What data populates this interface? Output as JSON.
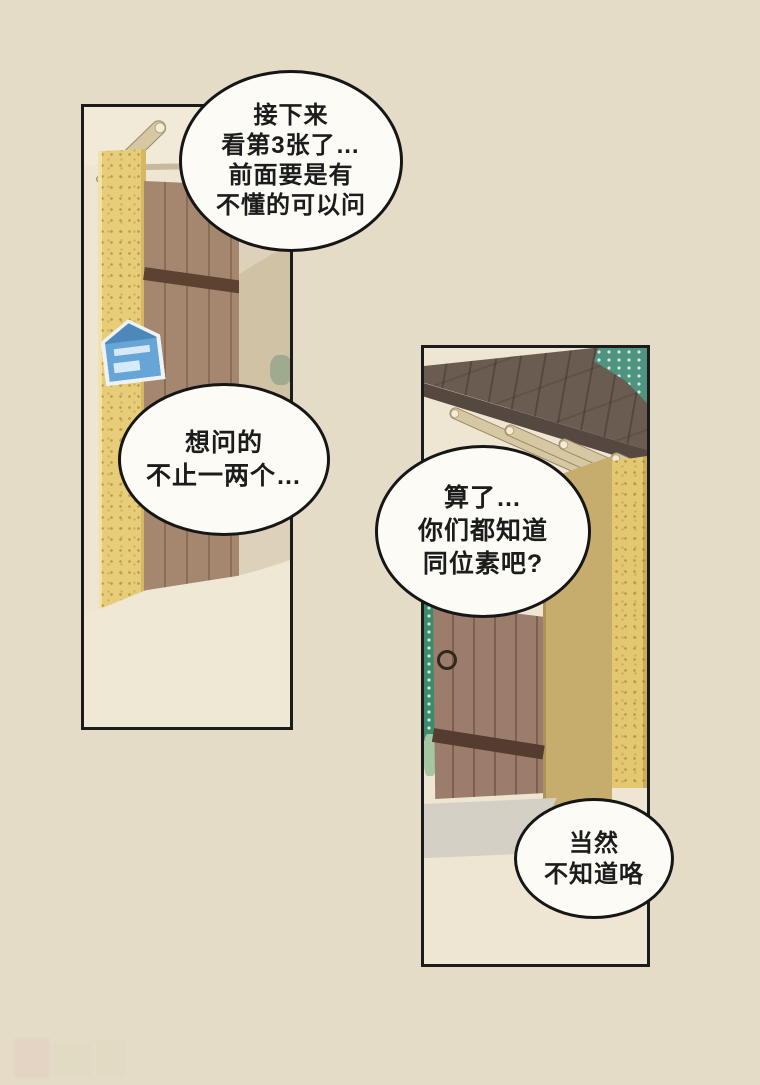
{
  "page": {
    "kind": "comic-page",
    "background": "#e5dcc8",
    "panel_background": "#eee6d3",
    "ink": "#1b1b1b",
    "bubble_fill": "#fdfbf5"
  },
  "colors": {
    "roof_dark": "#6b5c52",
    "rafter_tan": "#d6c8a2",
    "pillar_yellow": "#e7cd79",
    "door_brown_left": "#a5876f",
    "door_brown_right": "#9c7c6b",
    "door_band_dark": "#543d30",
    "plaque_blue": "#5f9fd3",
    "foliage_green": "#3e8a6d",
    "step_grey": "#d5d0c5"
  },
  "bubbles": [
    {
      "id": "bubble-1",
      "lines": [
        "接下来",
        "看第3张了…",
        "前面要是有",
        "不懂的可以问"
      ]
    },
    {
      "id": "bubble-2",
      "lines": [
        "想问的",
        "不止一两个…"
      ]
    },
    {
      "id": "bubble-3",
      "lines": [
        "算了…",
        "你们都知道",
        "同位素吧?"
      ]
    },
    {
      "id": "bubble-4",
      "lines": [
        "当然",
        "不知道咯"
      ]
    }
  ]
}
